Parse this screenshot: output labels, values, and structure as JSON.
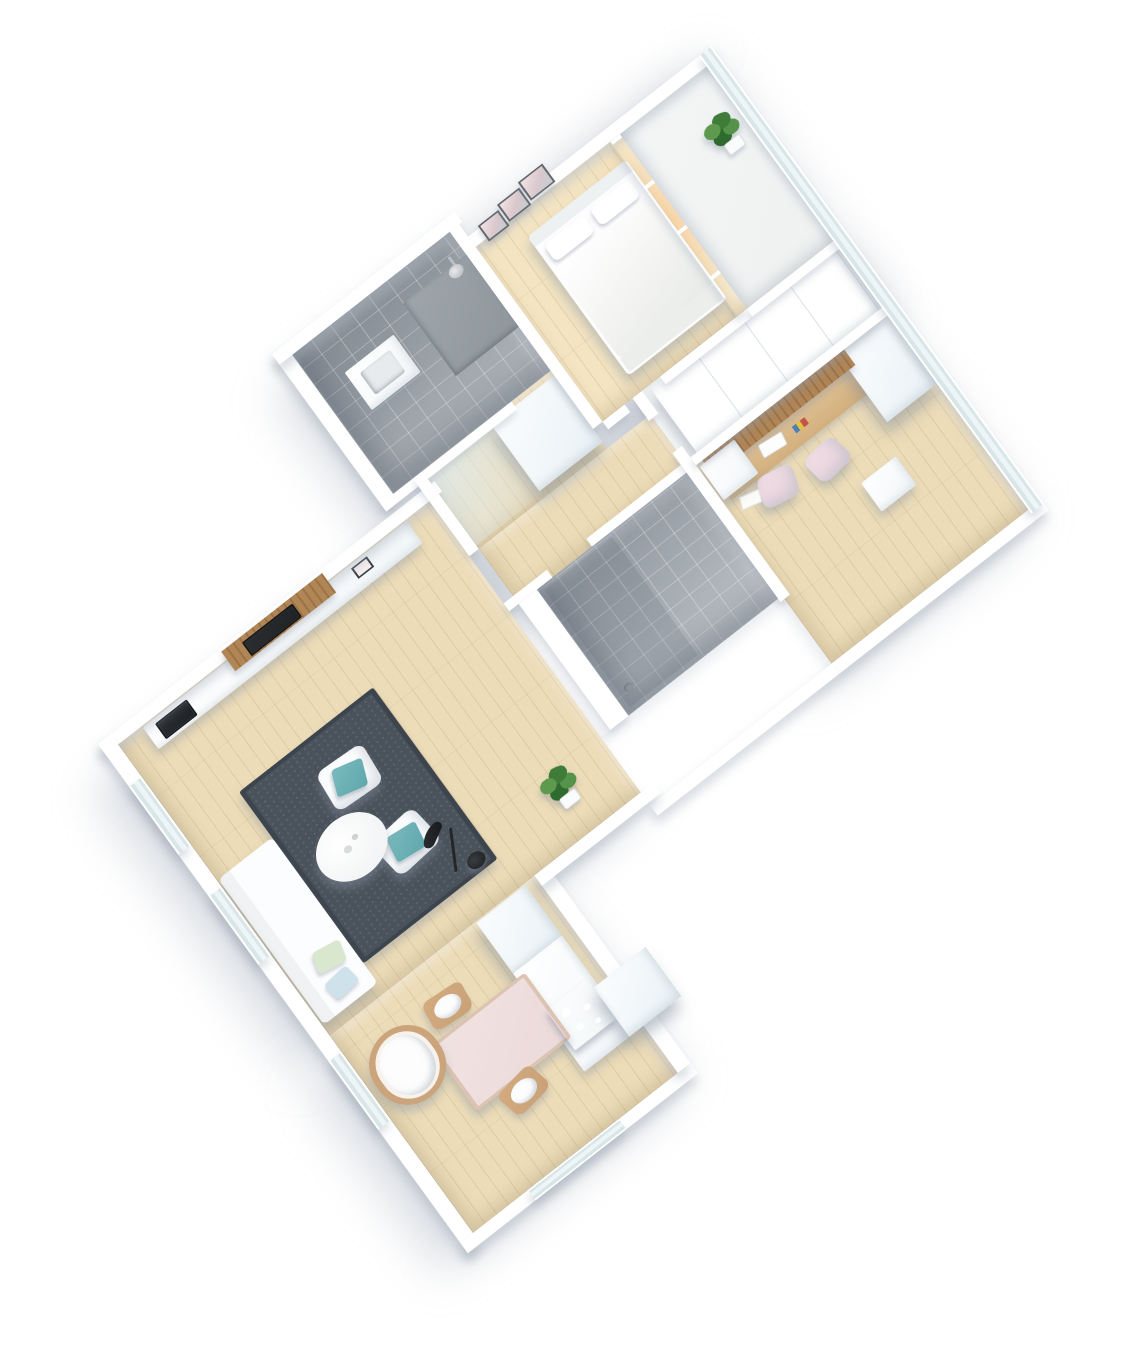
{
  "title": "isometric-3d-apartment-floor-plan-render",
  "colors": {
    "background": "#ffffff",
    "wall": "#ffffff",
    "glass_a": "#eef5f6",
    "glass_b": "#d9e6e8",
    "wood_a": "#ecdcb8",
    "wood_warm": "#f3e4c2",
    "tile_floor": "#b4bac0",
    "tile_floor_dark": "#a6acb2",
    "balcony": "#eff1f1",
    "cab_top": "#e9f1f5",
    "rug": "#4a525b",
    "rug_dark": "#3c444d",
    "teal": "#5fa7ac",
    "pillow_green": "#d9e7ce",
    "pillow_blue": "#cfe2ec",
    "pink": "#e7d2da",
    "table_pink": "#ecdada",
    "wood_mid": "#c9a178",
    "slat": "#b08657",
    "dark": "#202326",
    "cooktop": "#5a6167",
    "plant": "#3f7c39",
    "plant_light": "#5d9a4e",
    "shadow": "rgba(150,160,175,0.40)"
  },
  "rooms": [
    {
      "name": "bathroom-1",
      "floor": "gray-tile",
      "items": [
        "shower-head",
        "shower-tray",
        "washbasin"
      ]
    },
    {
      "name": "bedroom",
      "floor": "wood",
      "items": [
        "double-bed",
        "pillows",
        "wall-art-frames",
        "sliding-glass-wall"
      ]
    },
    {
      "name": "balcony",
      "floor": "concrete",
      "items": [
        "potted-plant",
        "glass-facade-band"
      ]
    },
    {
      "name": "hallway",
      "floor": "wood",
      "items": [
        "tall-wardrobe"
      ]
    },
    {
      "name": "corridor",
      "floor": "wood",
      "items": []
    },
    {
      "name": "office",
      "floor": "wood",
      "items": [
        "wood-slat-desk-wall",
        "floating-desk",
        "laptop",
        "pink-chair",
        "pink-chair",
        "white-cabinet",
        "wardrobe-row",
        "storage-cube",
        "paper-sheet"
      ]
    },
    {
      "name": "bathroom-2",
      "floor": "gray-tile",
      "items": [
        "walk-in-shower",
        "floor-drain"
      ]
    },
    {
      "name": "living-room",
      "floor": "wood",
      "items": [
        "media-console",
        "fireplace-insert",
        "wood-slat-tv-panel",
        "tv",
        "photo-frame",
        "area-rug",
        "armchair",
        "armchair",
        "teal-pillows",
        "round-coffee-table",
        "floor-lamp",
        "chaise-sofa",
        "potted-plant"
      ]
    },
    {
      "name": "kitchen-dining",
      "floor": "wood",
      "items": [
        "tall-cabinet",
        "kitchen-counter",
        "cooktop",
        "duct-box",
        "dining-table",
        "dining-chair",
        "dining-chair",
        "bassinet"
      ]
    }
  ],
  "windows": {
    "southwest_wall": 3,
    "south_wall": 1,
    "northeast_facade": "continuous-glass-band"
  }
}
